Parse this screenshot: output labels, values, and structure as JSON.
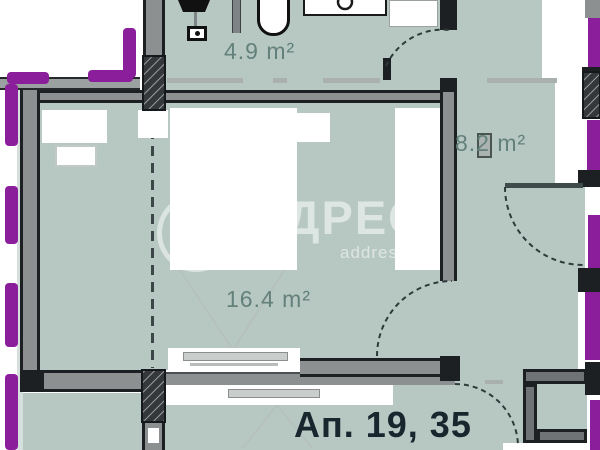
{
  "labels": {
    "bathroom_area": "4.9 m²",
    "corridor_area": "8.2 m²",
    "bedroom_area": "16.4 m²",
    "apartment": "Ап. 19, 35"
  },
  "watermark": {
    "brand": "ДРЕС",
    "sub": "address"
  },
  "rooms": [
    {
      "id": "bathroom",
      "area": "4.9 m²"
    },
    {
      "id": "corridor",
      "area": "8.2 m²"
    },
    {
      "id": "bedroom",
      "area": "16.4 m²"
    }
  ],
  "colors": {
    "room_fill": "#b7c8c3",
    "wall_gray": "#8d9091",
    "wall_dark": "#1c2022",
    "boundary_purple": "#8b1f9b",
    "area_label": "#64807b",
    "apartment_label": "#19262e",
    "watermark_white": "rgba(255,255,255,0.55)"
  }
}
